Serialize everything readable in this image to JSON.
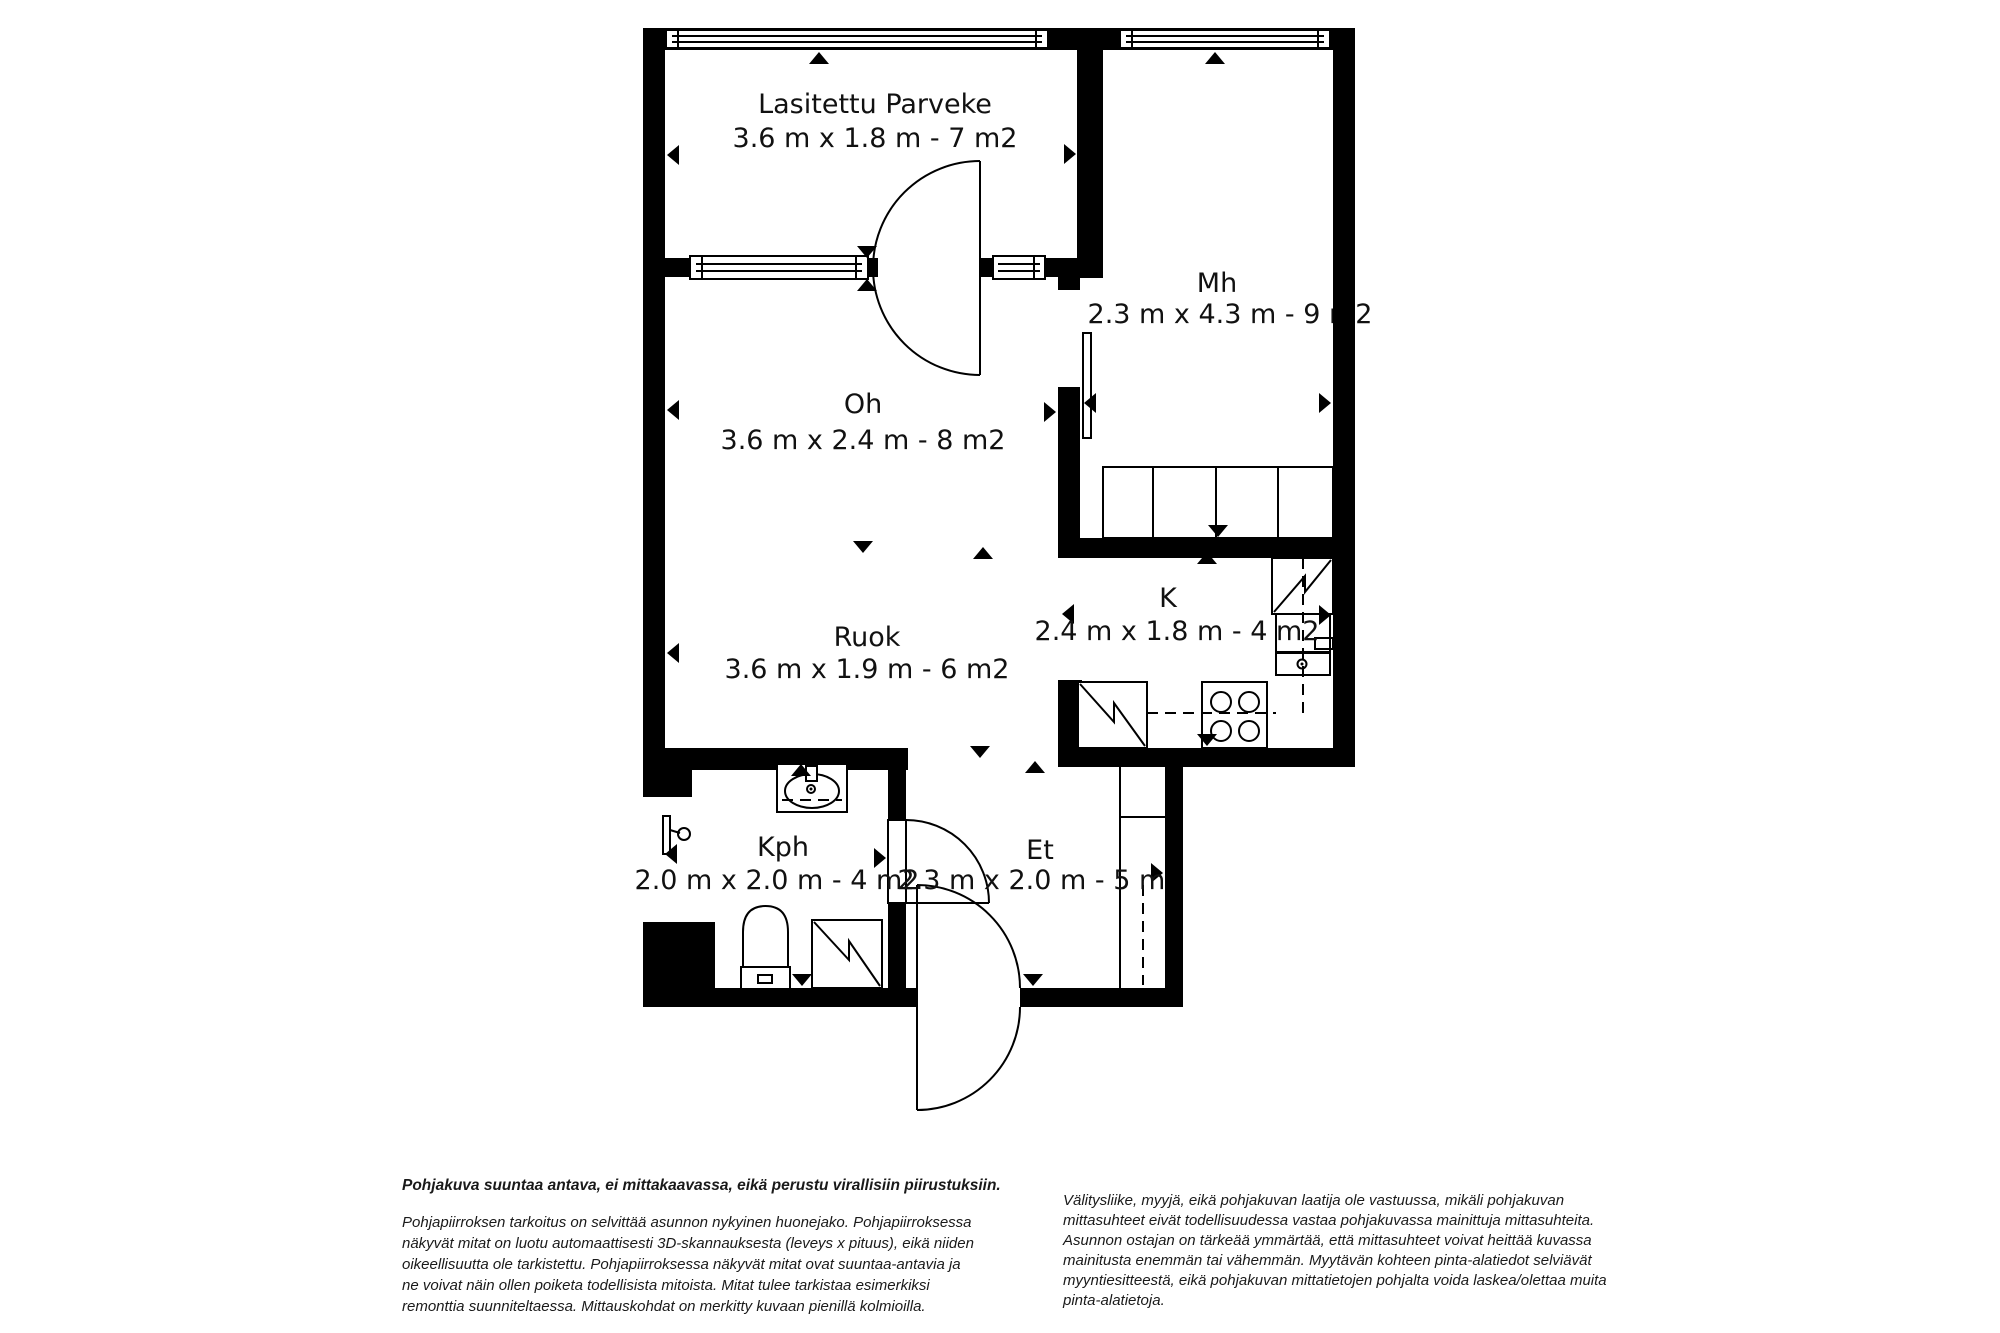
{
  "plan": {
    "type": "floor-plan",
    "language": "fi",
    "rooms": [
      {
        "key": "parveke",
        "name": "Lasitettu Parveke",
        "dims": "3.6 m x 1.8 m - 7 m2"
      },
      {
        "key": "mh",
        "name": "Mh",
        "dims": "2.3 m x 4.3 m - 9 m2"
      },
      {
        "key": "oh",
        "name": "Oh",
        "dims": "3.6 m x 2.4 m - 8 m2"
      },
      {
        "key": "ruok",
        "name": "Ruok",
        "dims": "3.6 m x 1.9 m - 6 m2"
      },
      {
        "key": "k",
        "name": "K",
        "dims": "2.4 m x 1.8 m - 4 m2"
      },
      {
        "key": "kph",
        "name": "Kph",
        "dims": "2.0 m x 2.0 m - 4 m2"
      },
      {
        "key": "et",
        "name": "Et",
        "dims": "2.3 m x 2.0 m - 5 m2"
      }
    ],
    "symbols": [
      "window",
      "door-swing",
      "sliding-door",
      "wardrobe",
      "fridge",
      "kitchen-sink",
      "stove",
      "dishwasher",
      "bathroom-sink",
      "shower",
      "toilet",
      "washing-machine",
      "measurement-triangle"
    ],
    "colors": {
      "wall": "#000000",
      "line": "#111111",
      "background": "#ffffff"
    }
  },
  "footer": {
    "left": {
      "title": "Pohjakuva suuntaa antava, ei mittakaavassa, eikä perustu virallisiin piirustuksiin.",
      "lines": [
        "Pohjapiirroksen tarkoitus on selvittää asunnon nykyinen huonejako. Pohjapiirroksessa",
        "näkyvät mitat on luotu automaattisesti 3D-skannauksesta (leveys x pituus), eikä niiden",
        "oikeellisuutta ole tarkistettu. Pohjapiirroksessa näkyvät mitat ovat suuntaa-antavia ja",
        "ne voivat näin ollen poiketa todellisista mitoista. Mitat tulee tarkistaa esimerkiksi",
        "remonttia suunniteltaessa. Mittauskohdat on merkitty kuvaan pienillä kolmioilla."
      ]
    },
    "right": {
      "lines": [
        "Välitysliike, myyjä, eikä pohjakuvan laatija ole vastuussa, mikäli pohjakuvan",
        "mittasuhteet eivät todellisuudessa vastaa pohjakuvassa mainittuja mittasuhteita.",
        "Asunnon ostajan on tärkeää ymmärtää, että mittasuhteet voivat heittää kuvassa",
        "mainitusta enemmän tai vähemmän. Myytävän kohteen pinta-alatiedot selviävät",
        "myyntiesitteestä, eikä pohjakuvan mittatietojen pohjalta voida laskea/olettaa muita",
        "pinta-alatietoja."
      ]
    }
  }
}
